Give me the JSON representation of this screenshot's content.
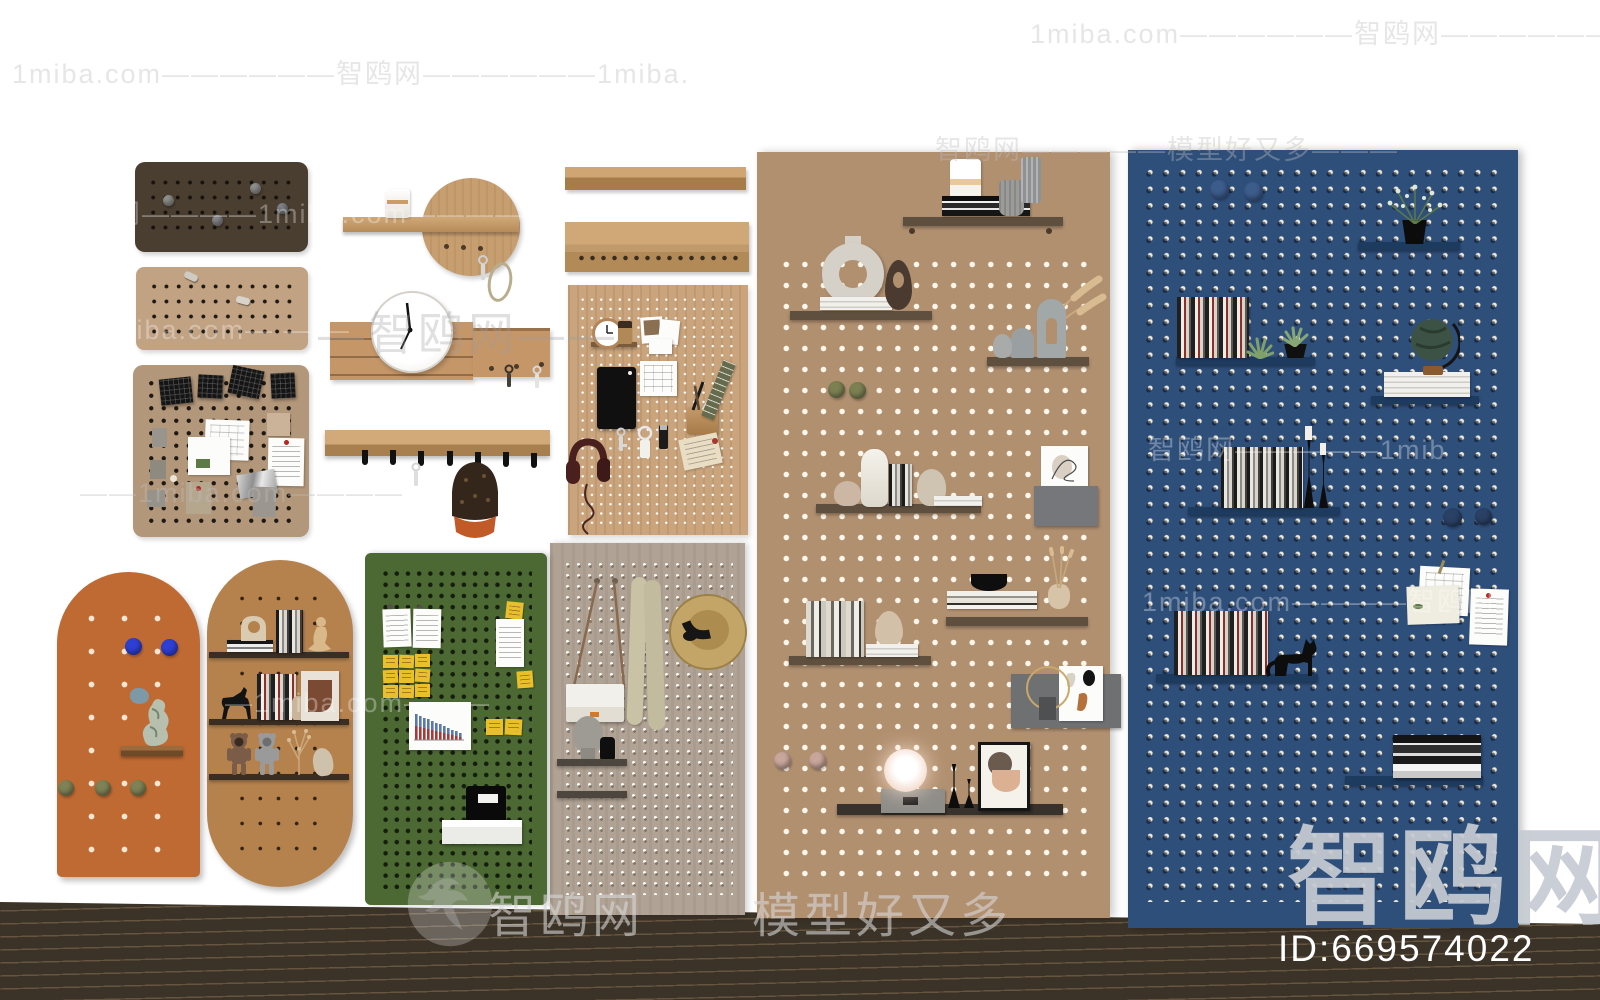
{
  "meta": {
    "site_name": "智鸥网",
    "site_domain": "1miba.com",
    "site_tagline": "模型好又多",
    "id_label": "ID:669574022"
  },
  "watermarks": {
    "row_top_right": "1miba.com——————智鸥网——————1mi",
    "row_2": "1miba.com——————智鸥网——————1miba.",
    "row_3": "智鸥网—————模型好又多———",
    "row_4": "智鸥网————1miba.com————",
    "row_5_tanboard": "1miba.com— — —",
    "row_clock": "—智鸥网——",
    "row_6_blue": "智鸥网—————1mib",
    "row_7": "——1miba.com————",
    "row_8_blue": "1miba.com————智鸥网",
    "row_9": "—1miba.com———",
    "bottom_site": "智鸥网",
    "bottom_tagline": "模型好又多",
    "big_site": "智鸥网"
  },
  "colors": {
    "background": "#ffffff",
    "floor": "#3b3228",
    "dark_board": "#4a3e30",
    "tan_board": "#c1a384",
    "memo_board": "#b3977a",
    "disc_wood": "#c79e6f",
    "organizer_wood": "#c59668",
    "wood_pegboard": "#c9a47c",
    "taupe_board": "#b0a294",
    "green_board": "#4d6933",
    "orange_board": "#bf6a33",
    "oval_board": "#b5824e",
    "large_tan_board": "#b19070",
    "blue_board": "#2f4f7b",
    "sticky_yellow": "#e9c02c",
    "cap_brim_orange": "#c05b28"
  },
  "boards": [
    {
      "name": "dark-pegboard",
      "items": [
        "gray-pin",
        "gray-pin",
        "gray-pin",
        "gray-pin"
      ]
    },
    {
      "name": "tan-pegboard",
      "items": [
        "metal-hook",
        "metal-hook"
      ]
    },
    {
      "name": "memo-pegboard",
      "items": [
        "woven-patch",
        "woven-patch",
        "woven-patch",
        "woven-patch",
        "sketch-paper",
        "photo-card",
        "gray-card",
        "gray-card",
        "gray-card",
        "beige-note",
        "handwritten-letter",
        "foil-wrapper",
        "receipt",
        "gray-note"
      ]
    },
    {
      "name": "round-entry-disc",
      "items": [
        "wood-shelf",
        "white-jar",
        "key-hooks",
        "keys",
        "rope-loop"
      ]
    },
    {
      "name": "key-organizer",
      "items": [
        "wall-clock",
        "key-hooks",
        "hanging-keys"
      ]
    },
    {
      "name": "coat-rack",
      "items": [
        "black-hooks-x7",
        "hanging-key",
        "baseball-cap"
      ]
    },
    {
      "name": "wall-rail-plain",
      "items": []
    },
    {
      "name": "wall-rail-hooks",
      "items": [
        "hook-row"
      ]
    },
    {
      "name": "wood-desk-pegboard",
      "items": [
        "clock",
        "cup",
        "polaroids",
        "calendar",
        "tablet",
        "pen-cup",
        "ruler",
        "keys",
        "keyring-tag",
        "usb-stick",
        "envelope",
        "headphones"
      ]
    },
    {
      "name": "taupe-pegboard",
      "items": [
        "handbag",
        "scarf",
        "straw-hat",
        "bust-sculpture",
        "black-vase",
        "shelf",
        "shelf"
      ]
    },
    {
      "name": "green-pegboard",
      "items": [
        "white-note",
        "white-note",
        "sticky-grid-3x3",
        "sticky-note",
        "document",
        "bar-chart-print",
        "sticky-note",
        "sticky-note",
        "black-sculpture",
        "white-shelf-box"
      ]
    },
    {
      "name": "orange-arch-pegboard",
      "items": [
        "blue-knob",
        "blue-knob",
        "stone-sculpture",
        "blue-rock",
        "wood-shelf",
        "olive-knob",
        "olive-knob",
        "olive-knob"
      ]
    },
    {
      "name": "oval-pegboard",
      "items": [
        "book-stack",
        "arch-sculpture",
        "books",
        "seated-figure",
        "horse-figurine",
        "books",
        "small-vase",
        "abstract-art",
        "bear-figures",
        "dry-branch",
        "stone"
      ]
    },
    {
      "name": "large-tan-pegboard",
      "items": [
        "candle-jar",
        "book-stack",
        "gray-pots",
        "ring-sculpture",
        "teardrop-vase",
        "arch-vases",
        "pampas-grass",
        "green-balls",
        "white-vases",
        "books",
        "art-print",
        "gray-box",
        "black-bowl",
        "book-stack",
        "bud-vase",
        "books",
        "vase",
        "gray-folder-art",
        "gold-ring",
        "pink-knobs",
        "glow-lamp",
        "candlesticks",
        "framed-picture"
      ]
    },
    {
      "name": "blue-pegboard",
      "items": [
        "blue-knob",
        "blue-knob",
        "potted-plant",
        "books",
        "succulents",
        "globe",
        "white-book-stack",
        "books",
        "black-candlesticks",
        "blue-knob",
        "blue-knob",
        "pinned-notes",
        "letter",
        "books",
        "cat-figure",
        "book-stack"
      ]
    }
  ]
}
